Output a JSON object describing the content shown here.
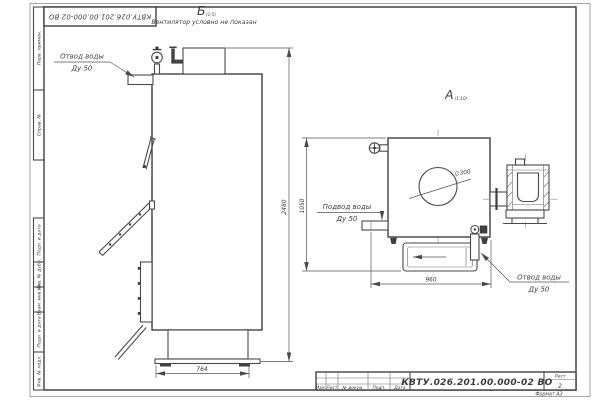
{
  "frame": {
    "doc_number_top": "КВТУ.026.201.00.000-02 ВО",
    "stamp_labels": {
      "perv": "Перв. примен.",
      "sprav": "Справ. №",
      "podp_data_1": "Подп. и дата",
      "inv_dubl": "Инв. № дубл.",
      "vzam_inv": "Взам. инв. №",
      "podp_data_2": "Подп. и дата",
      "inv_podl": "Инв. № подл."
    },
    "title_block": {
      "doc_number": "КВТУ.026.201.00.000-02 ВО",
      "sheet_label": "Лист",
      "sheet_number": "2",
      "format_label": "Формат А3",
      "rev_labels": [
        "Изм.",
        "Лист",
        "№ докум.",
        "Подп.",
        "Дата"
      ]
    }
  },
  "views": {
    "side": {
      "label": "Б",
      "scale": "(1:5)",
      "note": "Вентилятор условно не показан"
    },
    "top": {
      "label": "А",
      "scale": "(1:10)"
    }
  },
  "callouts": {
    "water_outlet_side": {
      "line1": "Отвод воды",
      "line2": "Ду 50"
    },
    "water_inlet_top": {
      "line1": "Подвод воды",
      "line2": "Ду 50"
    },
    "water_outlet_top": {
      "line1": "Отвод воды",
      "line2": "Ду 50"
    }
  },
  "dimensions": {
    "overall_height": "2480",
    "base_width": "764",
    "top_view_depth": "1050",
    "top_view_width": "960",
    "flue_diameter": "∅300"
  }
}
